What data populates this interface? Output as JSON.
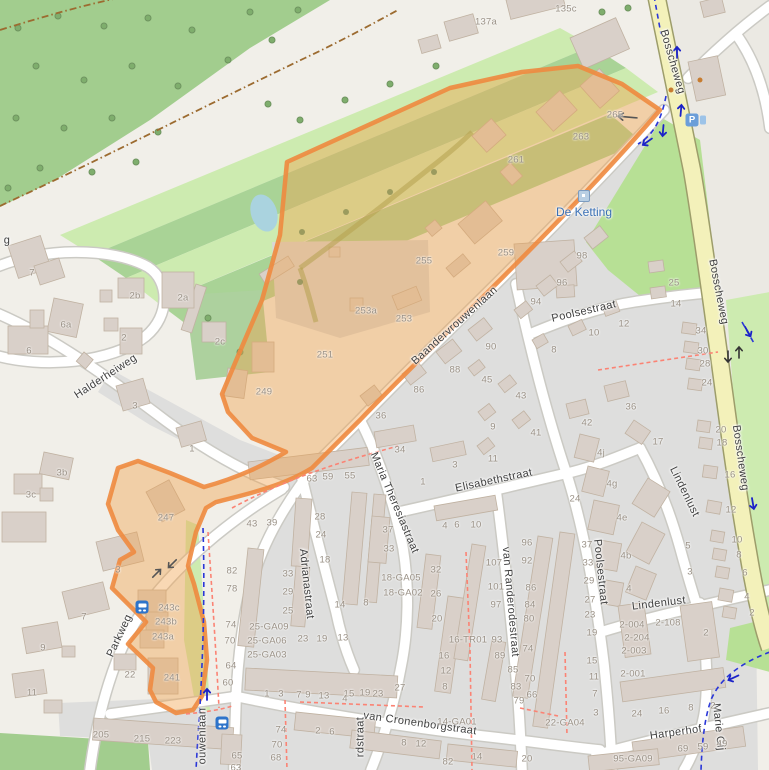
{
  "map": {
    "poi": {
      "de_ketting": {
        "label": "De Ketting",
        "x": 584,
        "y": 212,
        "icon_x": 584,
        "icon_y": 196
      }
    },
    "icons": {
      "parking": {
        "glyph": "P",
        "x": 692,
        "y": 120
      },
      "parking_mini": {
        "x": 703,
        "y": 120
      },
      "bus_stops": [
        {
          "x": 142,
          "y": 607
        },
        {
          "x": 222,
          "y": 723
        }
      ]
    },
    "colors": {
      "highlight_fill": "#f0a14d",
      "highlight_stroke": "#ee8a3f",
      "road_major": "#f3f1ba",
      "forest": "#a2cd8e",
      "grass_light": "#cdebb0",
      "grass_mid": "#a9d396",
      "residential": "#dededd",
      "building": "#d9d0c9",
      "water": "#aad3df",
      "cycleway": "#2936d8",
      "footpath": "#fb8374",
      "track": "#9c6b30",
      "street_label": "#3f3f3f",
      "housenumber": "#9a9186",
      "poi_blue": "#3a70b5"
    },
    "streets": [
      {
        "t": "Bosscheweg",
        "x": 672,
        "y": 62,
        "r": 74
      },
      {
        "t": "Bosscheweg",
        "x": 718,
        "y": 292,
        "r": 79
      },
      {
        "t": "Bosscheweg",
        "x": 740,
        "y": 458,
        "r": 82
      },
      {
        "t": "Baandervrouwenlaan",
        "x": 455,
        "y": 326,
        "r": -42
      },
      {
        "t": "Halderheiweg",
        "x": 106,
        "y": 377,
        "r": -33
      },
      {
        "t": "Parkweg",
        "x": 120,
        "y": 636,
        "r": -65
      },
      {
        "t": "Maria Theresiastraat",
        "x": 394,
        "y": 503,
        "r": 67
      },
      {
        "t": "Adrianastraat",
        "x": 306,
        "y": 584,
        "r": 84
      },
      {
        "t": "Elisabethstraat",
        "x": 494,
        "y": 481,
        "r": -12
      },
      {
        "t": "Poolsestraat",
        "x": 584,
        "y": 312,
        "r": -13
      },
      {
        "t": "Poolsestraat",
        "x": 600,
        "y": 572,
        "r": 84
      },
      {
        "t": "van Randerodestraat",
        "x": 510,
        "y": 602,
        "r": 85
      },
      {
        "t": "Lindenlust",
        "x": 684,
        "y": 492,
        "r": 64
      },
      {
        "t": "Lindenlust",
        "x": 659,
        "y": 604,
        "r": -7
      },
      {
        "t": "van Cronenborgstraat",
        "x": 420,
        "y": 724,
        "r": 8
      },
      {
        "t": "Harperhof",
        "x": 676,
        "y": 733,
        "r": -8
      },
      {
        "t": "Marie Gij",
        "x": 718,
        "y": 727,
        "r": 84
      },
      {
        "t": "ouwenlaan",
        "x": 203,
        "y": 736,
        "r": -90
      },
      {
        "t": "rdstraat",
        "x": 361,
        "y": 737,
        "r": -90
      },
      {
        "t": "g",
        "x": 7,
        "y": 241,
        "r": 0
      }
    ],
    "house_numbers": [
      {
        "t": "135c",
        "x": 566,
        "y": 9
      },
      {
        "t": "137a",
        "x": 486,
        "y": 22
      },
      {
        "t": "265",
        "x": 615,
        "y": 115
      },
      {
        "t": "263",
        "x": 581,
        "y": 137
      },
      {
        "t": "261",
        "x": 516,
        "y": 160
      },
      {
        "t": "259",
        "x": 506,
        "y": 253
      },
      {
        "t": "255",
        "x": 424,
        "y": 261
      },
      {
        "t": "253a",
        "x": 366,
        "y": 311
      },
      {
        "t": "253",
        "x": 404,
        "y": 319
      },
      {
        "t": "251",
        "x": 325,
        "y": 355
      },
      {
        "t": "249",
        "x": 264,
        "y": 392
      },
      {
        "t": "247",
        "x": 166,
        "y": 518
      },
      {
        "t": "243c",
        "x": 169,
        "y": 608
      },
      {
        "t": "243b",
        "x": 166,
        "y": 622
      },
      {
        "t": "243a",
        "x": 163,
        "y": 637
      },
      {
        "t": "241",
        "x": 172,
        "y": 678
      },
      {
        "t": "22",
        "x": 130,
        "y": 675
      },
      {
        "t": "205",
        "x": 101,
        "y": 735
      },
      {
        "t": "215",
        "x": 142,
        "y": 739
      },
      {
        "t": "223",
        "x": 173,
        "y": 741
      },
      {
        "t": "64",
        "x": 231,
        "y": 666
      },
      {
        "t": "60",
        "x": 228,
        "y": 683
      },
      {
        "t": "65",
        "x": 237,
        "y": 756
      },
      {
        "t": "63",
        "x": 236,
        "y": 768
      },
      {
        "t": "7",
        "x": 32,
        "y": 273
      },
      {
        "t": "6a",
        "x": 66,
        "y": 325
      },
      {
        "t": "6",
        "x": 29,
        "y": 351
      },
      {
        "t": "2b",
        "x": 135,
        "y": 296
      },
      {
        "t": "2a",
        "x": 183,
        "y": 298
      },
      {
        "t": "2c",
        "x": 220,
        "y": 342
      },
      {
        "t": "2",
        "x": 124,
        "y": 338
      },
      {
        "t": "3",
        "x": 135,
        "y": 406
      },
      {
        "t": "1",
        "x": 192,
        "y": 449
      },
      {
        "t": "3b",
        "x": 62,
        "y": 473
      },
      {
        "t": "3c",
        "x": 31,
        "y": 495
      },
      {
        "t": "3",
        "x": 118,
        "y": 570
      },
      {
        "t": "7",
        "x": 84,
        "y": 617
      },
      {
        "t": "9",
        "x": 43,
        "y": 648
      },
      {
        "t": "11",
        "x": 32,
        "y": 693
      },
      {
        "t": "98",
        "x": 582,
        "y": 256
      },
      {
        "t": "96",
        "x": 562,
        "y": 283
      },
      {
        "t": "94",
        "x": 536,
        "y": 302
      },
      {
        "t": "90",
        "x": 491,
        "y": 347
      },
      {
        "t": "88",
        "x": 455,
        "y": 370
      },
      {
        "t": "86",
        "x": 419,
        "y": 390
      },
      {
        "t": "45",
        "x": 487,
        "y": 380
      },
      {
        "t": "43",
        "x": 521,
        "y": 396
      },
      {
        "t": "41",
        "x": 536,
        "y": 433
      },
      {
        "t": "9",
        "x": 493,
        "y": 427
      },
      {
        "t": "11",
        "x": 493,
        "y": 459
      },
      {
        "t": "36",
        "x": 381,
        "y": 416
      },
      {
        "t": "36",
        "x": 631,
        "y": 407
      },
      {
        "t": "42",
        "x": 587,
        "y": 423
      },
      {
        "t": "25",
        "x": 674,
        "y": 283
      },
      {
        "t": "14",
        "x": 676,
        "y": 304
      },
      {
        "t": "12",
        "x": 624,
        "y": 324
      },
      {
        "t": "10",
        "x": 594,
        "y": 333
      },
      {
        "t": "8",
        "x": 554,
        "y": 350
      },
      {
        "t": "17",
        "x": 658,
        "y": 442
      },
      {
        "t": "4j",
        "x": 601,
        "y": 453
      },
      {
        "t": "4g",
        "x": 612,
        "y": 484
      },
      {
        "t": "4e",
        "x": 622,
        "y": 518
      },
      {
        "t": "4b",
        "x": 626,
        "y": 556
      },
      {
        "t": "4",
        "x": 629,
        "y": 589
      },
      {
        "t": "5",
        "x": 688,
        "y": 546
      },
      {
        "t": "3",
        "x": 690,
        "y": 572
      },
      {
        "t": "34",
        "x": 400,
        "y": 450
      },
      {
        "t": "3",
        "x": 455,
        "y": 465
      },
      {
        "t": "1",
        "x": 423,
        "y": 482
      },
      {
        "t": "63",
        "x": 312,
        "y": 479
      },
      {
        "t": "59",
        "x": 328,
        "y": 477
      },
      {
        "t": "55",
        "x": 350,
        "y": 476
      },
      {
        "t": "43",
        "x": 252,
        "y": 524
      },
      {
        "t": "39",
        "x": 272,
        "y": 523
      },
      {
        "t": "28",
        "x": 320,
        "y": 517
      },
      {
        "t": "24",
        "x": 321,
        "y": 535
      },
      {
        "t": "18",
        "x": 325,
        "y": 560
      },
      {
        "t": "37",
        "x": 388,
        "y": 530
      },
      {
        "t": "33",
        "x": 389,
        "y": 549
      },
      {
        "t": "18-GA05",
        "x": 401,
        "y": 578
      },
      {
        "t": "18-GA02",
        "x": 403,
        "y": 593
      },
      {
        "t": "14",
        "x": 340,
        "y": 605
      },
      {
        "t": "8",
        "x": 366,
        "y": 603
      },
      {
        "t": "4",
        "x": 445,
        "y": 526
      },
      {
        "t": "6",
        "x": 457,
        "y": 525
      },
      {
        "t": "10",
        "x": 476,
        "y": 525
      },
      {
        "t": "32",
        "x": 436,
        "y": 570
      },
      {
        "t": "26",
        "x": 436,
        "y": 594
      },
      {
        "t": "20",
        "x": 437,
        "y": 619
      },
      {
        "t": "82",
        "x": 232,
        "y": 571
      },
      {
        "t": "78",
        "x": 232,
        "y": 589
      },
      {
        "t": "74",
        "x": 231,
        "y": 625
      },
      {
        "t": "70",
        "x": 230,
        "y": 641
      },
      {
        "t": "33",
        "x": 288,
        "y": 574
      },
      {
        "t": "29",
        "x": 288,
        "y": 592
      },
      {
        "t": "25",
        "x": 288,
        "y": 611
      },
      {
        "t": "25-GA09",
        "x": 269,
        "y": 627
      },
      {
        "t": "25-GA06",
        "x": 267,
        "y": 641
      },
      {
        "t": "25-GA03",
        "x": 267,
        "y": 655
      },
      {
        "t": "23",
        "x": 303,
        "y": 639
      },
      {
        "t": "19",
        "x": 322,
        "y": 639
      },
      {
        "t": "13",
        "x": 343,
        "y": 638
      },
      {
        "t": "1",
        "x": 267,
        "y": 694
      },
      {
        "t": "3",
        "x": 281,
        "y": 694
      },
      {
        "t": "7",
        "x": 299,
        "y": 695
      },
      {
        "t": "9",
        "x": 308,
        "y": 695
      },
      {
        "t": "13",
        "x": 324,
        "y": 696
      },
      {
        "t": "15",
        "x": 349,
        "y": 694
      },
      {
        "t": "19",
        "x": 365,
        "y": 693
      },
      {
        "t": "23",
        "x": 378,
        "y": 694
      },
      {
        "t": "27",
        "x": 400,
        "y": 688
      },
      {
        "t": "74",
        "x": 281,
        "y": 730
      },
      {
        "t": "70",
        "x": 277,
        "y": 745
      },
      {
        "t": "68",
        "x": 276,
        "y": 758
      },
      {
        "t": "2",
        "x": 318,
        "y": 731
      },
      {
        "t": "6",
        "x": 332,
        "y": 732
      },
      {
        "t": "8",
        "x": 404,
        "y": 743
      },
      {
        "t": "12",
        "x": 421,
        "y": 744
      },
      {
        "t": "82",
        "x": 448,
        "y": 762
      },
      {
        "t": "14",
        "x": 477,
        "y": 757
      },
      {
        "t": "20",
        "x": 527,
        "y": 759
      },
      {
        "t": "16-TR01",
        "x": 468,
        "y": 640
      },
      {
        "t": "93",
        "x": 497,
        "y": 640
      },
      {
        "t": "16",
        "x": 444,
        "y": 656
      },
      {
        "t": "12",
        "x": 446,
        "y": 671
      },
      {
        "t": "8",
        "x": 445,
        "y": 687
      },
      {
        "t": "4",
        "x": 345,
        "y": 699
      },
      {
        "t": "97",
        "x": 496,
        "y": 605
      },
      {
        "t": "89",
        "x": 500,
        "y": 656
      },
      {
        "t": "85",
        "x": 513,
        "y": 670
      },
      {
        "t": "83",
        "x": 516,
        "y": 687
      },
      {
        "t": "79",
        "x": 519,
        "y": 701
      },
      {
        "t": "14-GA01",
        "x": 457,
        "y": 722
      },
      {
        "t": "22-GA04",
        "x": 565,
        "y": 723
      },
      {
        "t": "107",
        "x": 494,
        "y": 563
      },
      {
        "t": "101",
        "x": 496,
        "y": 587
      },
      {
        "t": "96",
        "x": 527,
        "y": 543
      },
      {
        "t": "92",
        "x": 527,
        "y": 561
      },
      {
        "t": "86",
        "x": 531,
        "y": 588
      },
      {
        "t": "84",
        "x": 530,
        "y": 605
      },
      {
        "t": "80",
        "x": 529,
        "y": 619
      },
      {
        "t": "74",
        "x": 528,
        "y": 649
      },
      {
        "t": "70",
        "x": 530,
        "y": 679
      },
      {
        "t": "66",
        "x": 532,
        "y": 695
      },
      {
        "t": "37",
        "x": 587,
        "y": 545
      },
      {
        "t": "33",
        "x": 588,
        "y": 563
      },
      {
        "t": "29",
        "x": 589,
        "y": 581
      },
      {
        "t": "27",
        "x": 590,
        "y": 600
      },
      {
        "t": "23",
        "x": 590,
        "y": 615
      },
      {
        "t": "19",
        "x": 592,
        "y": 633
      },
      {
        "t": "15",
        "x": 592,
        "y": 661
      },
      {
        "t": "11",
        "x": 594,
        "y": 677
      },
      {
        "t": "7",
        "x": 595,
        "y": 694
      },
      {
        "t": "3",
        "x": 596,
        "y": 713
      },
      {
        "t": "24",
        "x": 575,
        "y": 499
      },
      {
        "t": "2-004",
        "x": 632,
        "y": 625
      },
      {
        "t": "2-108",
        "x": 668,
        "y": 623
      },
      {
        "t": "2-204",
        "x": 637,
        "y": 638
      },
      {
        "t": "2-003",
        "x": 634,
        "y": 651
      },
      {
        "t": "2-001",
        "x": 633,
        "y": 674
      },
      {
        "t": "2",
        "x": 706,
        "y": 633
      },
      {
        "t": "24",
        "x": 637,
        "y": 714
      },
      {
        "t": "16",
        "x": 664,
        "y": 711
      },
      {
        "t": "8",
        "x": 691,
        "y": 708
      },
      {
        "t": "2",
        "x": 713,
        "y": 706
      },
      {
        "t": "69",
        "x": 683,
        "y": 749
      },
      {
        "t": "59",
        "x": 703,
        "y": 747
      },
      {
        "t": "49",
        "x": 722,
        "y": 744
      },
      {
        "t": "95-GA09",
        "x": 633,
        "y": 759
      },
      {
        "t": "34",
        "x": 701,
        "y": 331
      },
      {
        "t": "30",
        "x": 703,
        "y": 351
      },
      {
        "t": "28",
        "x": 705,
        "y": 364
      },
      {
        "t": "24",
        "x": 707,
        "y": 383
      },
      {
        "t": "20",
        "x": 721,
        "y": 430
      },
      {
        "t": "18",
        "x": 722,
        "y": 443
      },
      {
        "t": "16",
        "x": 730,
        "y": 475
      },
      {
        "t": "12",
        "x": 731,
        "y": 510
      },
      {
        "t": "10",
        "x": 737,
        "y": 540
      },
      {
        "t": "8",
        "x": 739,
        "y": 555
      },
      {
        "t": "6",
        "x": 745,
        "y": 573
      },
      {
        "t": "4",
        "x": 747,
        "y": 597
      },
      {
        "t": "2",
        "x": 752,
        "y": 613
      }
    ]
  }
}
